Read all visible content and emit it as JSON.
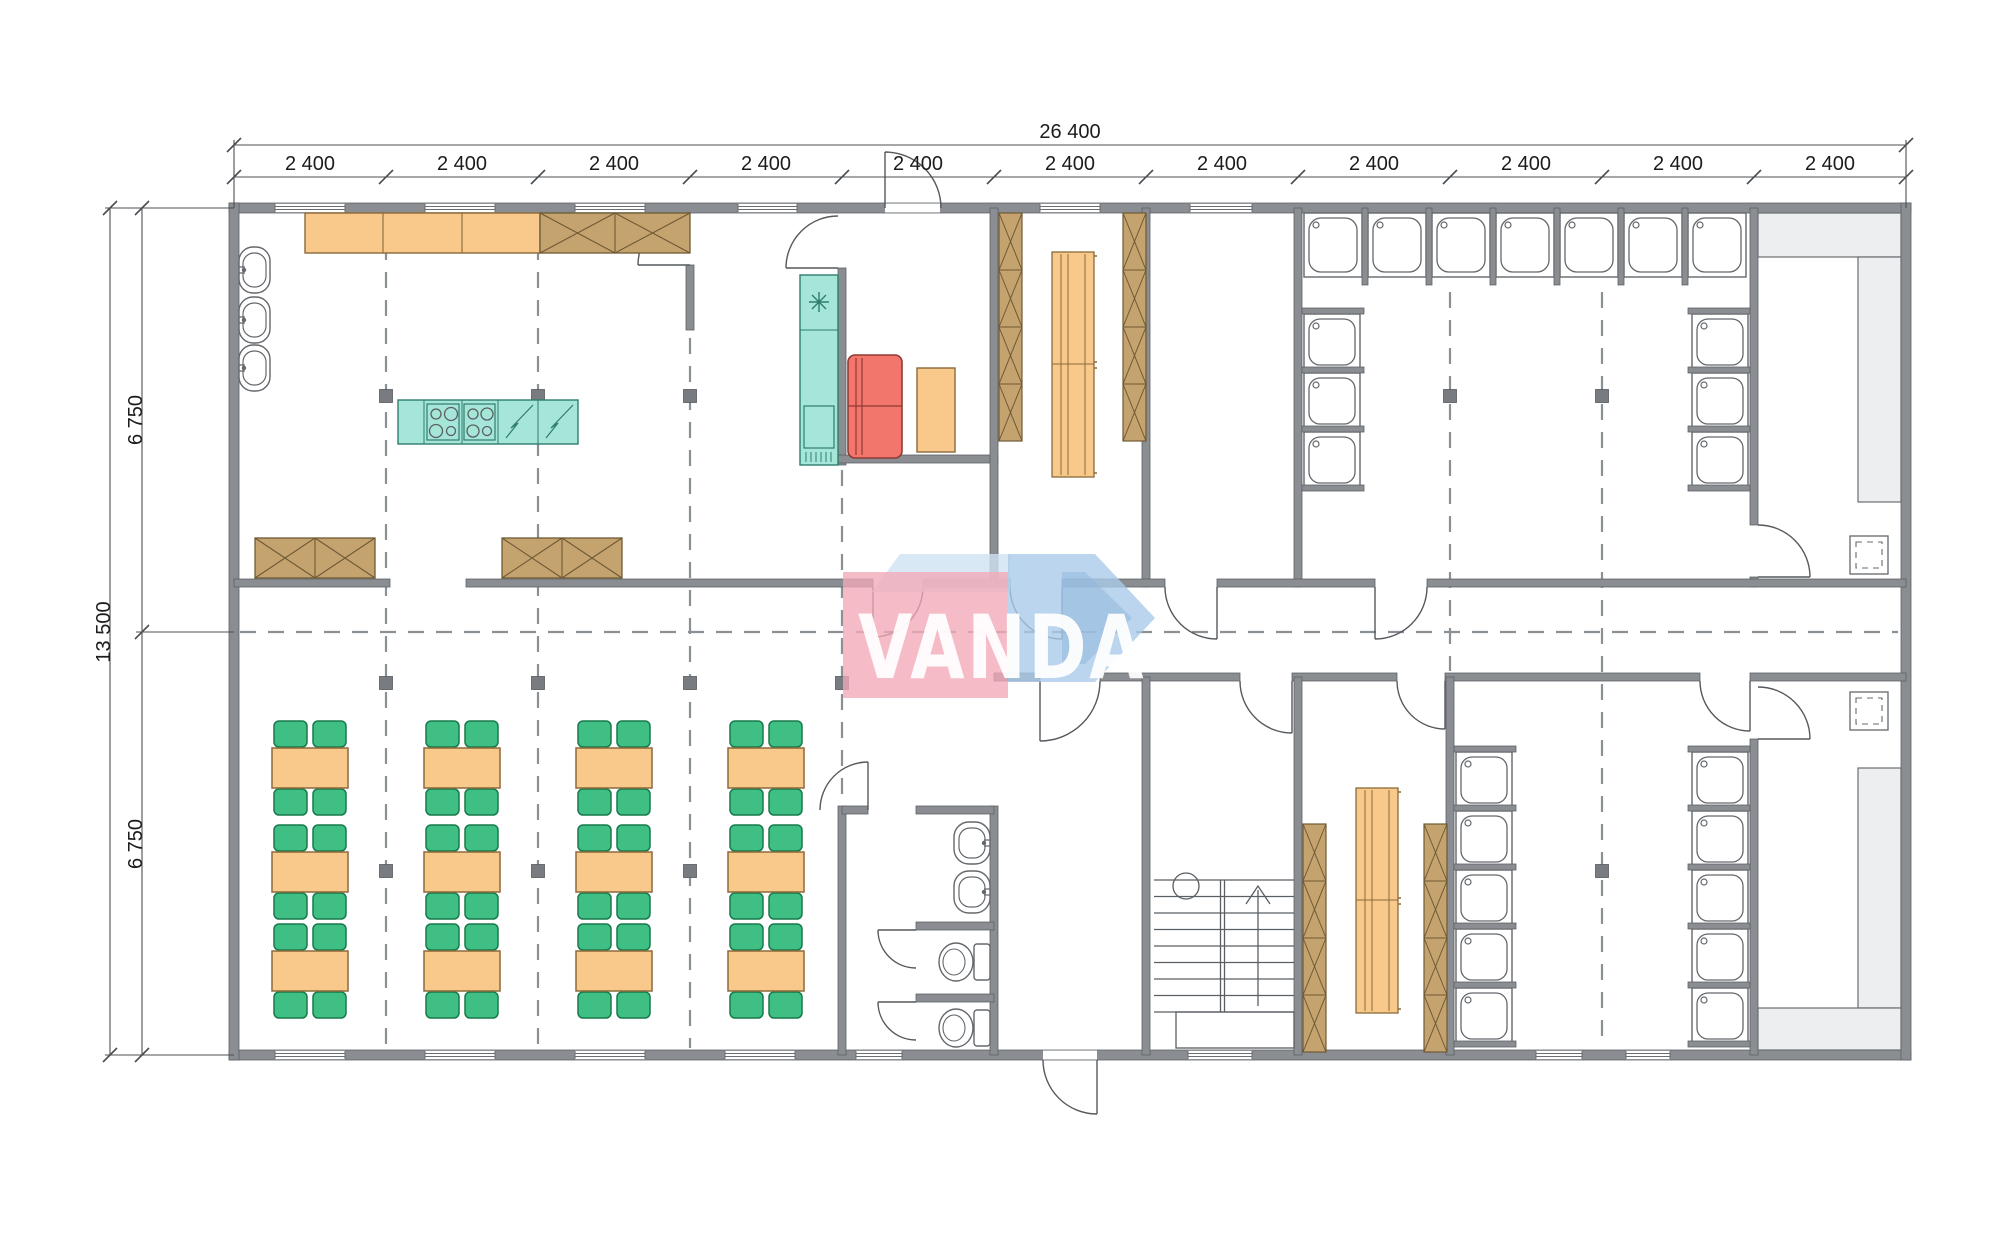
{
  "plan": {
    "watermark_text": "VANDA",
    "dimensions": {
      "top_total_label": "26 400",
      "top_segment_labels": [
        "2 400",
        "2 400",
        "2 400",
        "2 400",
        "2 400",
        "2 400",
        "2 400",
        "2 400",
        "2 400",
        "2 400",
        "2 400"
      ],
      "left_total_label": "13 500",
      "left_segment_labels": [
        "6 750",
        "6 750"
      ]
    },
    "colors": {
      "wall_gray": "#8a8e92",
      "counter_orange": "#f9c98c",
      "cabinet_brown": "#c4a36f",
      "appliance_teal": "#a5e6d8",
      "fridge_red": "#f3766d",
      "chair_green": "#3fbf84",
      "logo_pink": "#f2a9b8",
      "logo_blue": "#a9cbe8"
    }
  }
}
